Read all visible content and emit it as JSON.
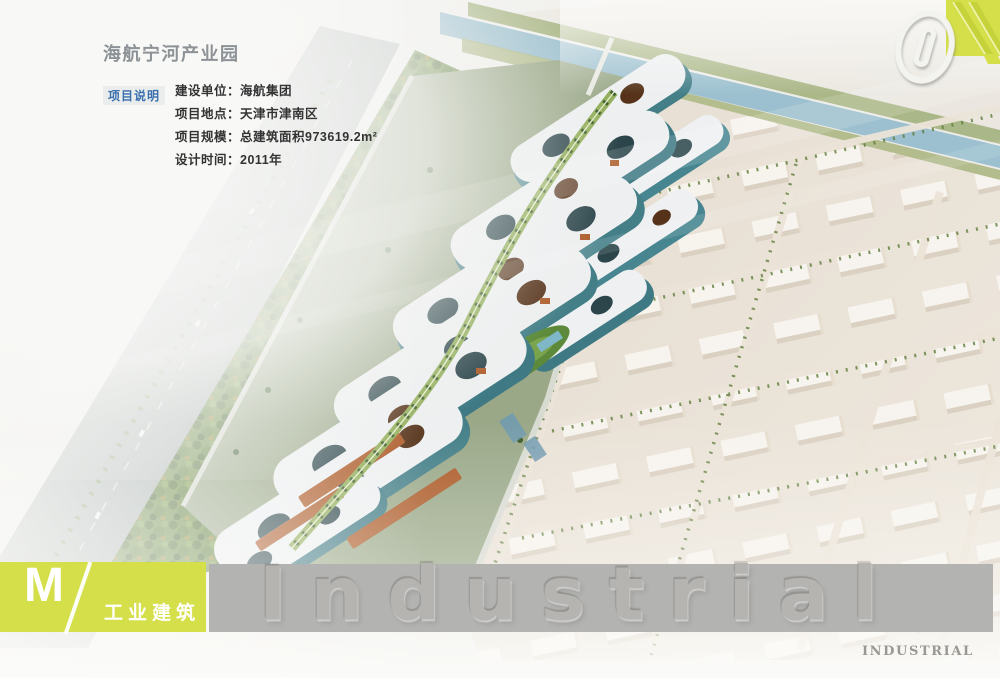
{
  "colors": {
    "accent_yellow_green": "#d5df49",
    "band_gray": "#b3b3b1",
    "label_blue": "#3b6fae",
    "title_gray": "#8d9296"
  },
  "header": {
    "title": "海航宁河产业园",
    "section_label": "项目说明",
    "info_rows": [
      {
        "label": "建设单位：",
        "value": "海航集团"
      },
      {
        "label": "项目地点：",
        "value": "天津市津南区"
      },
      {
        "label": "项目规模：",
        "value": "总建筑面积973619.2m²"
      },
      {
        "label": "设计时间：",
        "value": "2011年"
      }
    ]
  },
  "page_number": "01",
  "footer": {
    "section_letter": "M",
    "category_label": "工业建筑",
    "watermark": "Industrial",
    "caption": "INDUSTRIAL"
  }
}
